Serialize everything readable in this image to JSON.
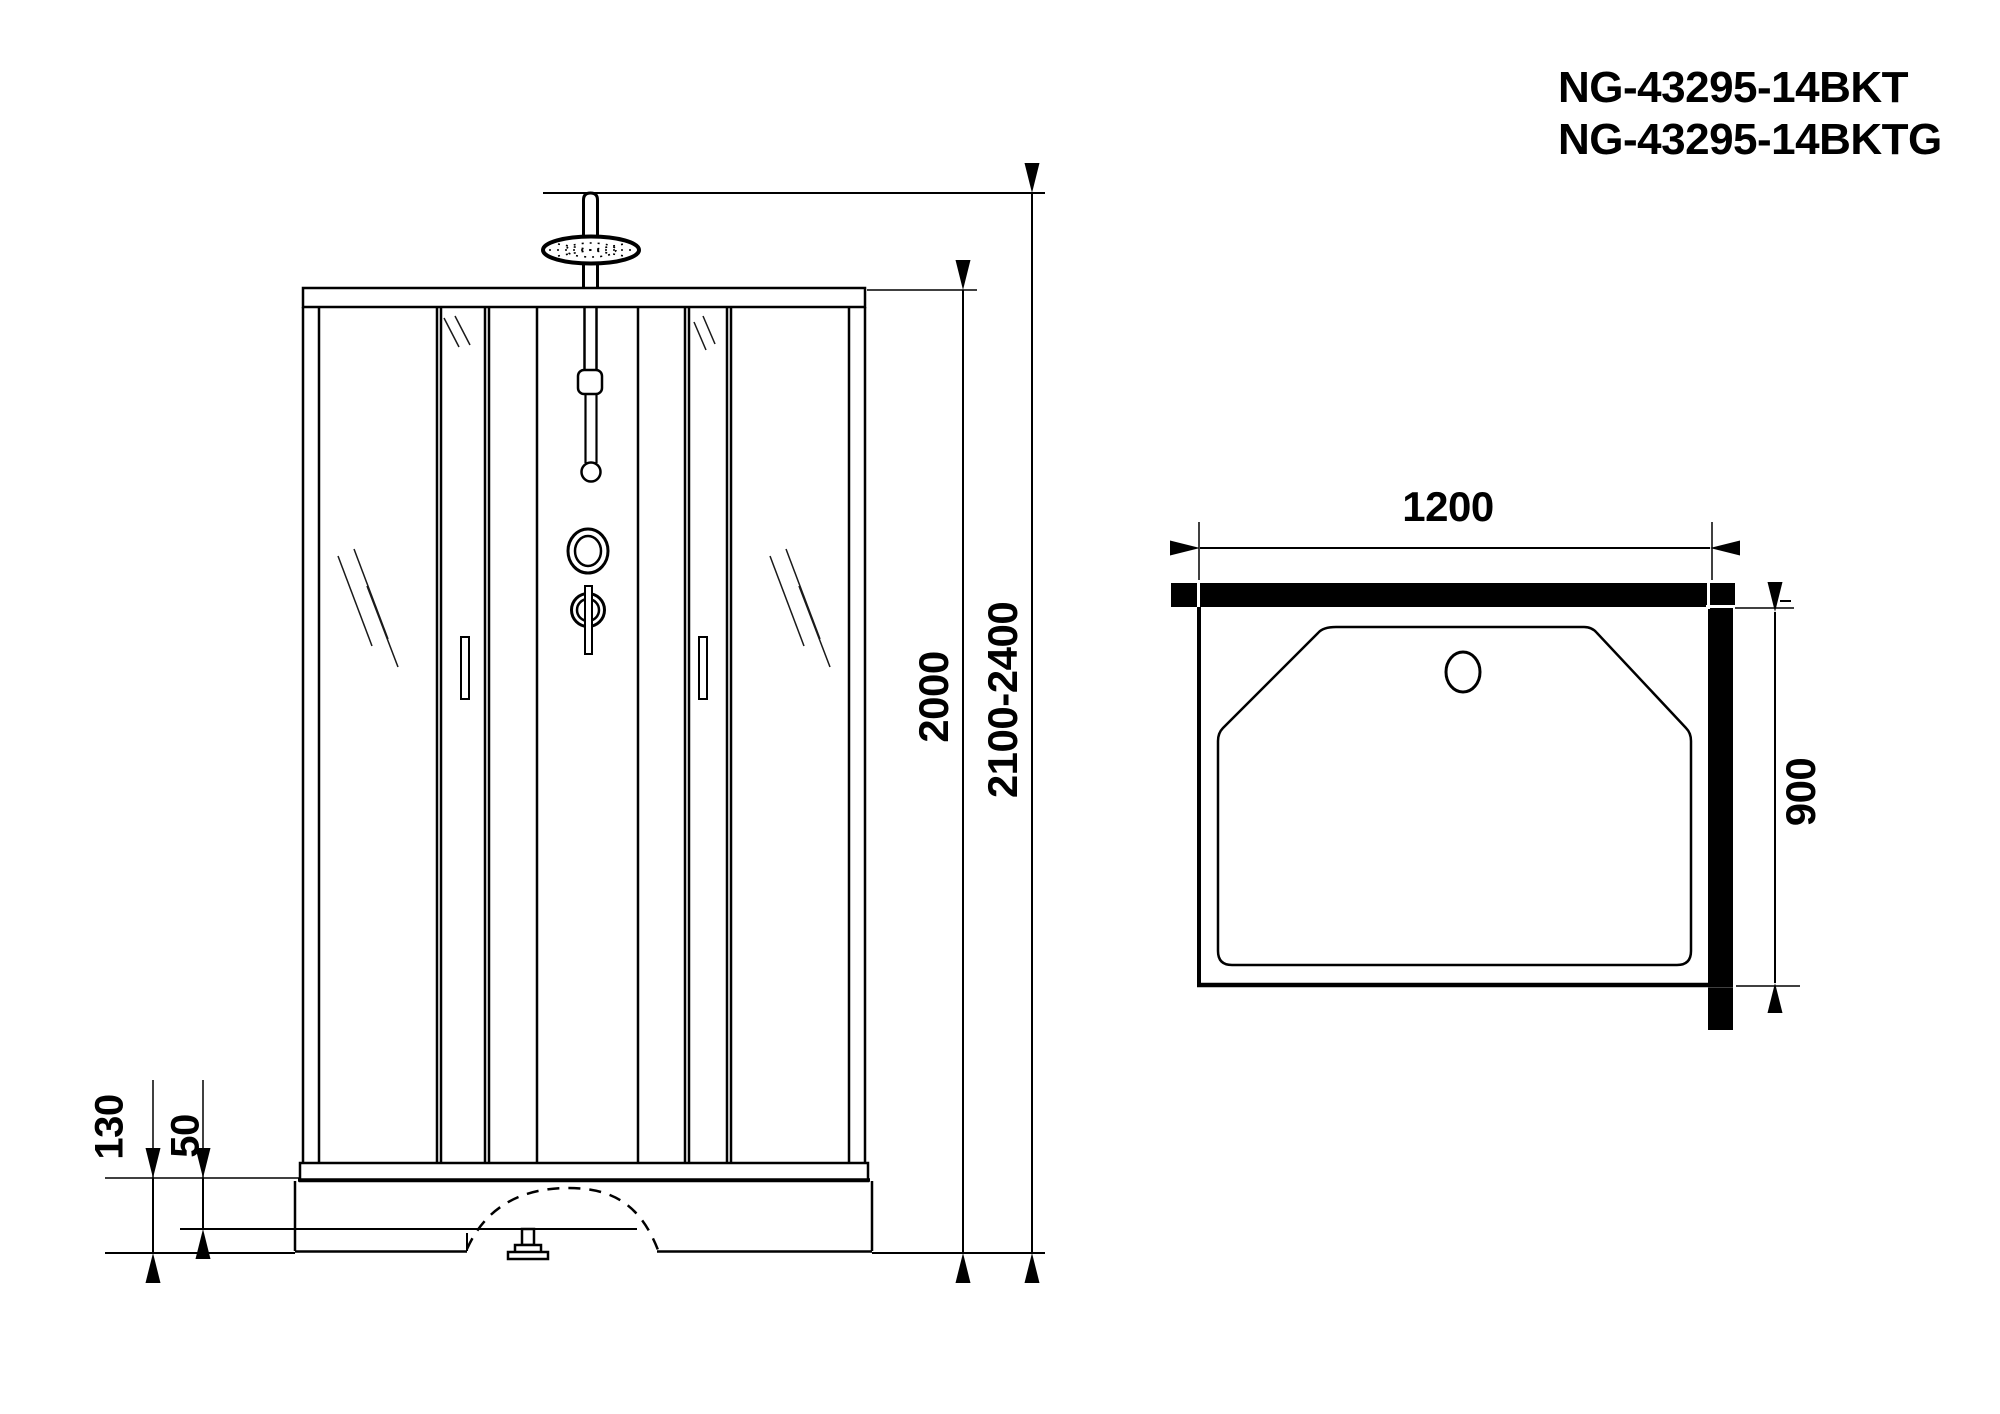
{
  "colors": {
    "ink": "#000000",
    "paper": "#ffffff"
  },
  "header": {
    "model_line1": "NG-43295-14BKT",
    "model_line2": "NG-43295-14BKTG"
  },
  "front_view": {
    "dim_cabin_height": "2000",
    "dim_overall_height": "2100-2400",
    "dim_tray_height": "130",
    "dim_tray_step": "50"
  },
  "top_view": {
    "dim_width": "1200",
    "dim_depth": "900"
  }
}
